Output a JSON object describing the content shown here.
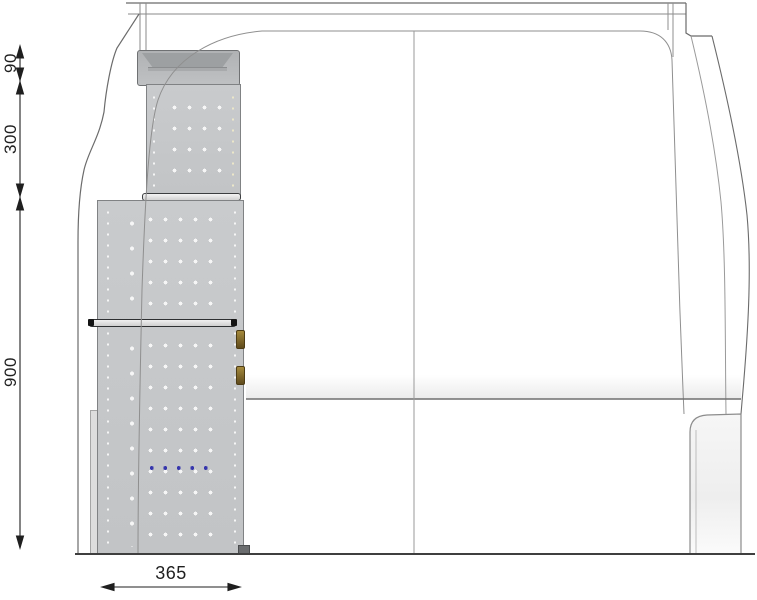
{
  "dimensions": {
    "tray_height": "90",
    "upper_height": "300",
    "lower_height": "900",
    "depth": "365"
  },
  "colors": {
    "panel": "#c6c8ca",
    "panel-dark": "#9da0a2",
    "outline": "#77797b",
    "van-line": "#7b7b7b",
    "dim": "#1f1f1f",
    "blue": "#3636ac",
    "hook": "#8a7030"
  }
}
